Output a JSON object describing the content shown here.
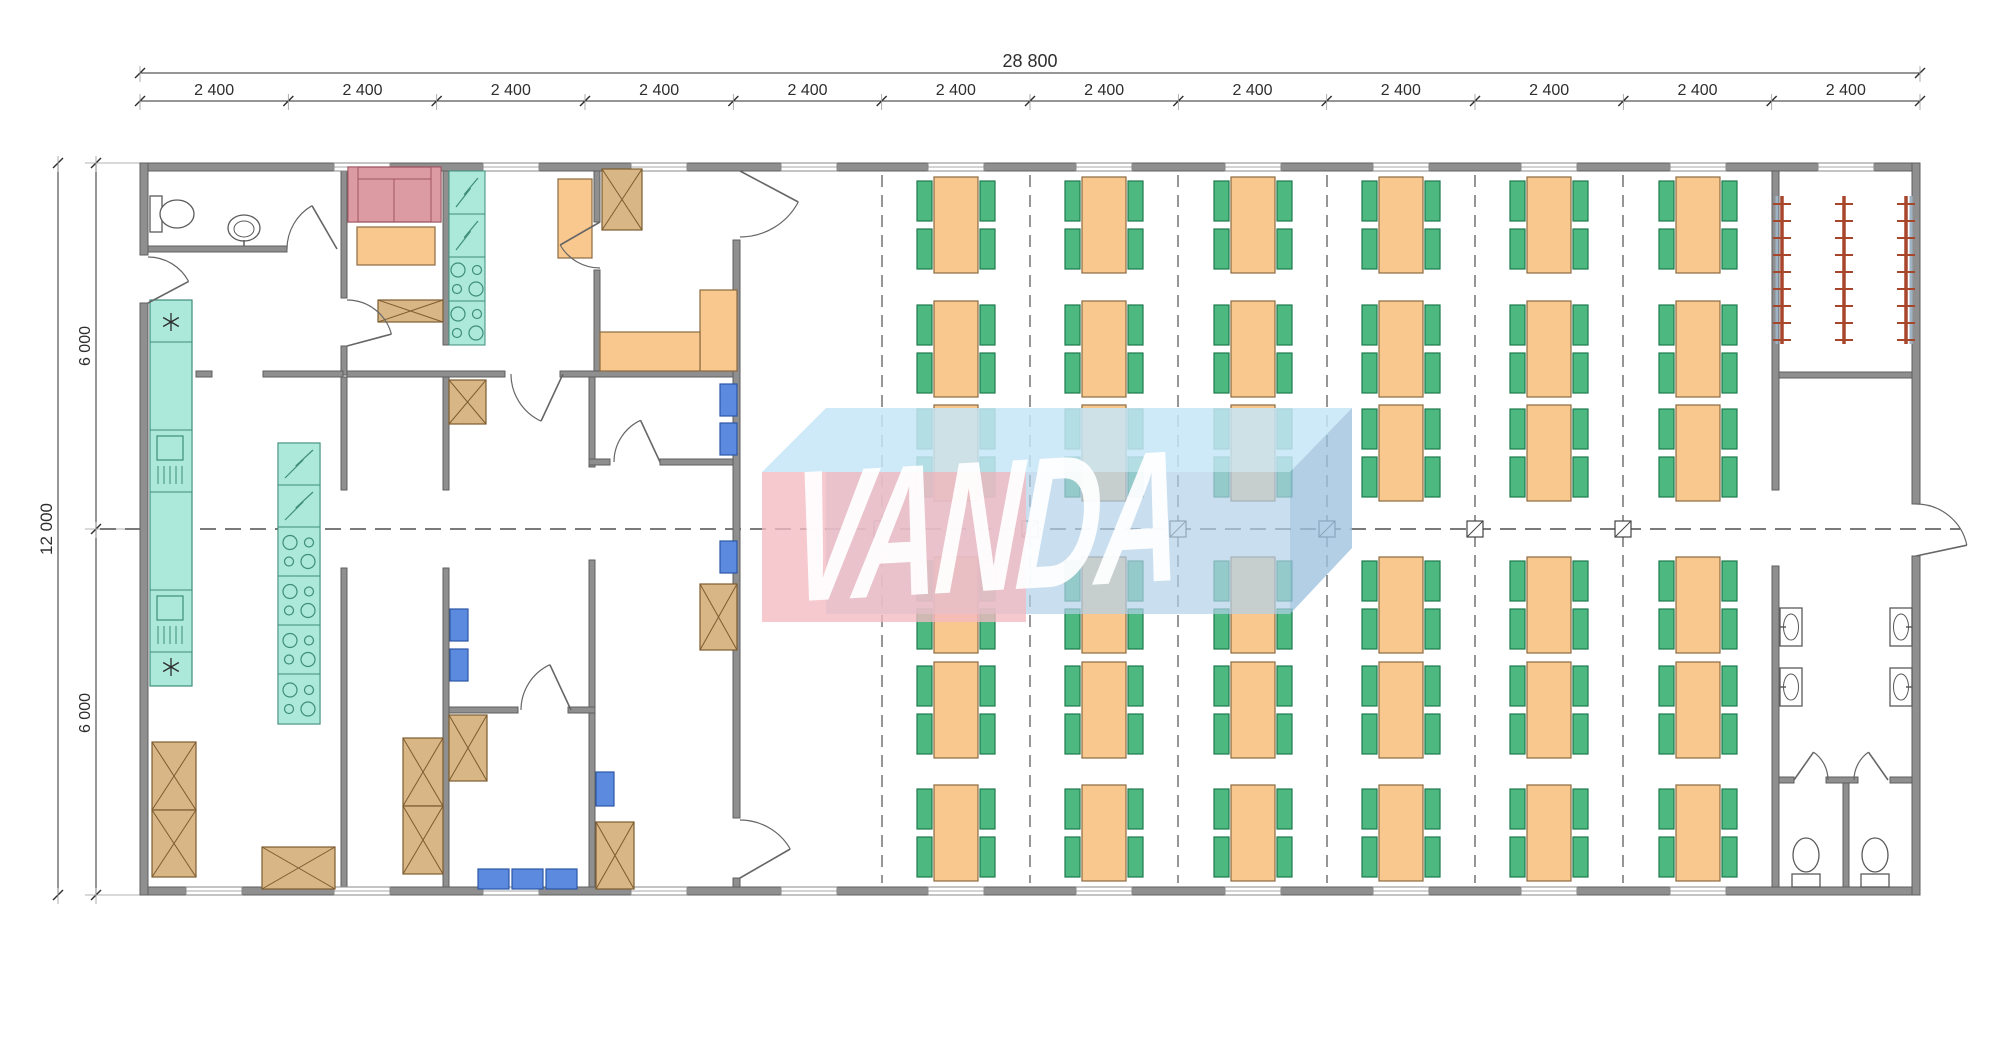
{
  "page": {
    "type": "architectural-floor-plan",
    "background": "#ffffff"
  },
  "watermark": {
    "text": "VANDA",
    "text_color": "rgba(255,255,255,0.93)",
    "pink_front": "rgba(243,186,194,0.78)",
    "blue_top": "rgba(198,229,246,0.85)",
    "blue_front": "rgba(178,209,233,0.70)",
    "blue_side": "rgba(156,193,223,0.78)"
  },
  "dimensions": {
    "overall_width_label": "28 800",
    "bay_label": "2 400",
    "bay_count": 12,
    "overall_height_label": "12 000",
    "half_height_label": "6 000",
    "half_count": 2
  },
  "plan_summary": {
    "dining_table_columns": 6,
    "dining_table_rows": 6,
    "dining_tables": 36,
    "chairs_per_table": 4,
    "structural_posts": 6,
    "coat_racks": 3,
    "wash_basins": 4,
    "toilets": 3,
    "kitchen_sinks": 2,
    "stove_units": 6,
    "fridge_units": 4
  },
  "colors": {
    "wall": "#8f8f8f",
    "wall_edge": "#5f5f5f",
    "table": "#f9c88e",
    "table_edge": "#8a6a40",
    "chair": "#4db981",
    "chair_edge": "#1e7a4e",
    "counter": "#ace9da",
    "counter_edge": "#3f8d7b",
    "cabinet": "#d8b685",
    "cabinet_edge": "#7c5c30",
    "sofa": "#dc9aa3",
    "sofa_edge": "#9e5560",
    "seat_blue": "#5b8ade",
    "seat_blue_edge": "#2d57a5",
    "rack": "#a8462c",
    "rack_rail": "#9fb3c4",
    "fixture_edge": "#5a5a5a",
    "axis": "#4f4f4f",
    "dimension": "#2e2e2e",
    "window_edge": "#8a8a8a",
    "door": "#666666"
  }
}
